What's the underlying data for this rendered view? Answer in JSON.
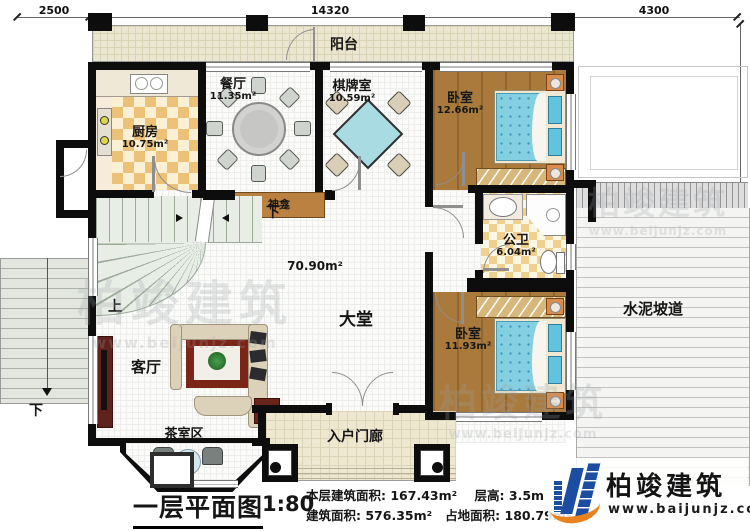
{
  "dimensions": {
    "top_left": "2500",
    "top_center": "14320",
    "top_right": "4300",
    "right_side": "13180"
  },
  "rooms": {
    "balcony": {
      "name": "阳台"
    },
    "kitchen": {
      "name": "厨房",
      "area": "10.75m²"
    },
    "dining": {
      "name": "餐厅",
      "area": "11.35m²"
    },
    "mahjong": {
      "name": "棋牌室",
      "area": "10.59m²"
    },
    "bedroom_top": {
      "name": "卧室",
      "area": "12.66m²"
    },
    "bathroom": {
      "name": "公卫",
      "area": "6.04m²"
    },
    "hall": {
      "name": "大堂",
      "area": "70.90m²"
    },
    "living": {
      "name": "客厅"
    },
    "tea_area": {
      "name": "茶室区"
    },
    "bedroom_bottom": {
      "name": "卧室",
      "area": "11.93m²"
    },
    "porch": {
      "name": "入户门廊"
    },
    "ramp": {
      "name": "水泥坡道"
    },
    "shrine": {
      "name": "神龛"
    }
  },
  "stairs": {
    "up": "上",
    "down_interior": "下",
    "down_exterior": "下"
  },
  "title_block": {
    "title": "一层平面图",
    "scale": "1:80",
    "stats": [
      {
        "label": "本层建筑面积:",
        "value": "167.43m²"
      },
      {
        "label": "层高:",
        "value": "3.5m"
      },
      {
        "label": "建筑面积:",
        "value": "576.35m²"
      },
      {
        "label": "占地面积:",
        "value": "180.79m²"
      }
    ]
  },
  "brand": {
    "name": "柏竣建筑",
    "website": "www.baijunjz.com"
  },
  "watermark": {
    "name": "柏竣建筑",
    "website": "www.beijunjz.com"
  }
}
